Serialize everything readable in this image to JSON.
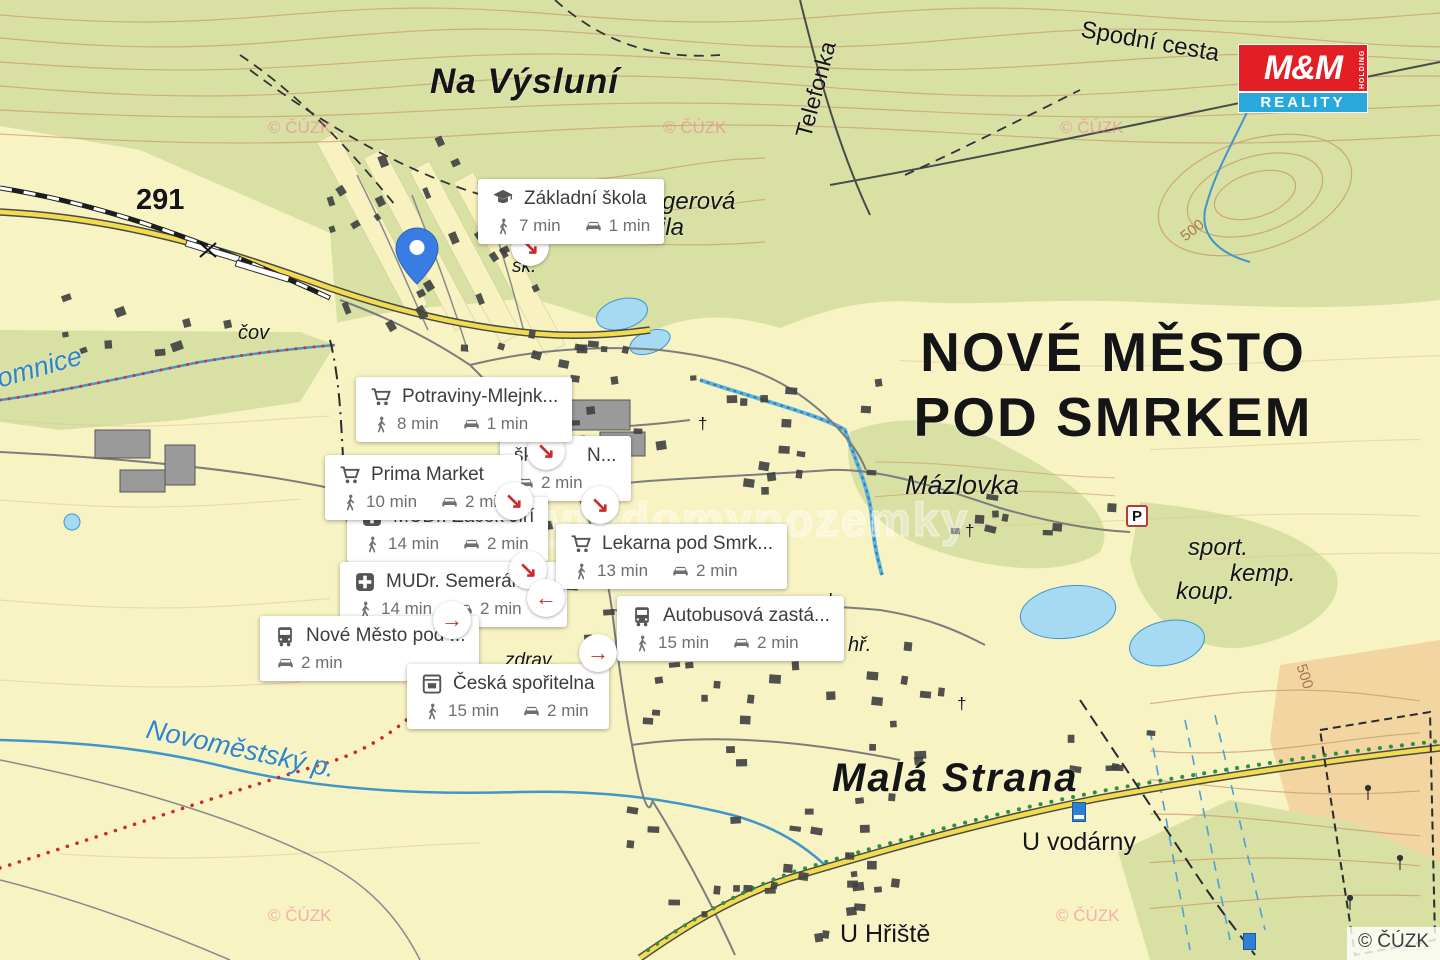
{
  "colors": {
    "base": "#f8f3c3",
    "forest": "#d9e0a3",
    "pale_strip": "#f7f2bf",
    "contour": "#c89a6c",
    "contour_light": "#e3c49b",
    "water": "#a6d9f2",
    "water_line": "#3f96cc",
    "road_yellow": "#f2dc4e",
    "trail_red": "#cc2431",
    "trail_green": "#2f9040",
    "pin_blue": "#3a7de2",
    "marker_red": "#cd2b2b",
    "logo_red": "#e31e24",
    "logo_blue": "#29a8dc"
  },
  "logo": {
    "mm": "M&M",
    "holding": "HOLDING",
    "reality": "REALITY"
  },
  "copyright_bar": "© ČÚZK",
  "watermark_pink": "© ČÚZK",
  "watermark_center": "bytydomypozemky",
  "map_labels": {
    "na_vysluni": "Na Výsluní",
    "road_291": "291",
    "cov": "čov",
    "omnice": "omnice",
    "telefonka": "Telefonka",
    "spodni_cesta": "Spodní cesta",
    "klingerova": "Klingerová",
    "vila": "vila",
    "city_line1": "NOVÉ MĚSTO",
    "city_line2": "POD SMRKEM",
    "mazlovka": "Mázlovka",
    "mala_strana": "Malá Strana",
    "u_vodarny": "U vodárny",
    "u_hriste": "U Hřiště",
    "novomestsky": "Novoměstský p.",
    "sport": "sport.",
    "kemp": "kemp.",
    "koup": "koup.",
    "hr": "hř.",
    "sk_small": "šk.",
    "zdrav": "zdrav.",
    "c500a": "500",
    "c500b": "500",
    "parking": "P",
    "cross": "†"
  },
  "pois": [
    {
      "name": "Základní škola",
      "walk": "7 min",
      "drive": "1 min"
    },
    {
      "name": "Potraviny-Mlejnk...",
      "walk": "8 min",
      "drive": "1 min"
    },
    {
      "name": "Prima Market",
      "walk": "10 min",
      "drive": "2 min"
    },
    {
      "name": "MUDr. Žáček Jiří",
      "walk": "14 min",
      "drive": "2 min"
    },
    {
      "name_left": "šk",
      "name_right": "N...",
      "drive": "2 min"
    },
    {
      "name": "MUDr. Semerák V...",
      "walk": "14 min",
      "drive": "2 min"
    },
    {
      "name": "Lekarna pod Smrk...",
      "walk": "13 min",
      "drive": "2 min"
    },
    {
      "name": "Nové Město pod ...",
      "drive": "2 min"
    },
    {
      "name": "Autobusová zastá...",
      "walk": "15 min",
      "drive": "2 min"
    },
    {
      "name": "Česká spořitelna",
      "walk": "15 min",
      "drive": "2 min"
    }
  ],
  "markers": [
    {
      "glyph": "↘"
    },
    {
      "glyph": "↘"
    },
    {
      "glyph": "↘"
    },
    {
      "glyph": "↘"
    },
    {
      "glyph": "↘"
    },
    {
      "glyph": "←"
    },
    {
      "glyph": "→"
    },
    {
      "glyph": "→"
    }
  ]
}
